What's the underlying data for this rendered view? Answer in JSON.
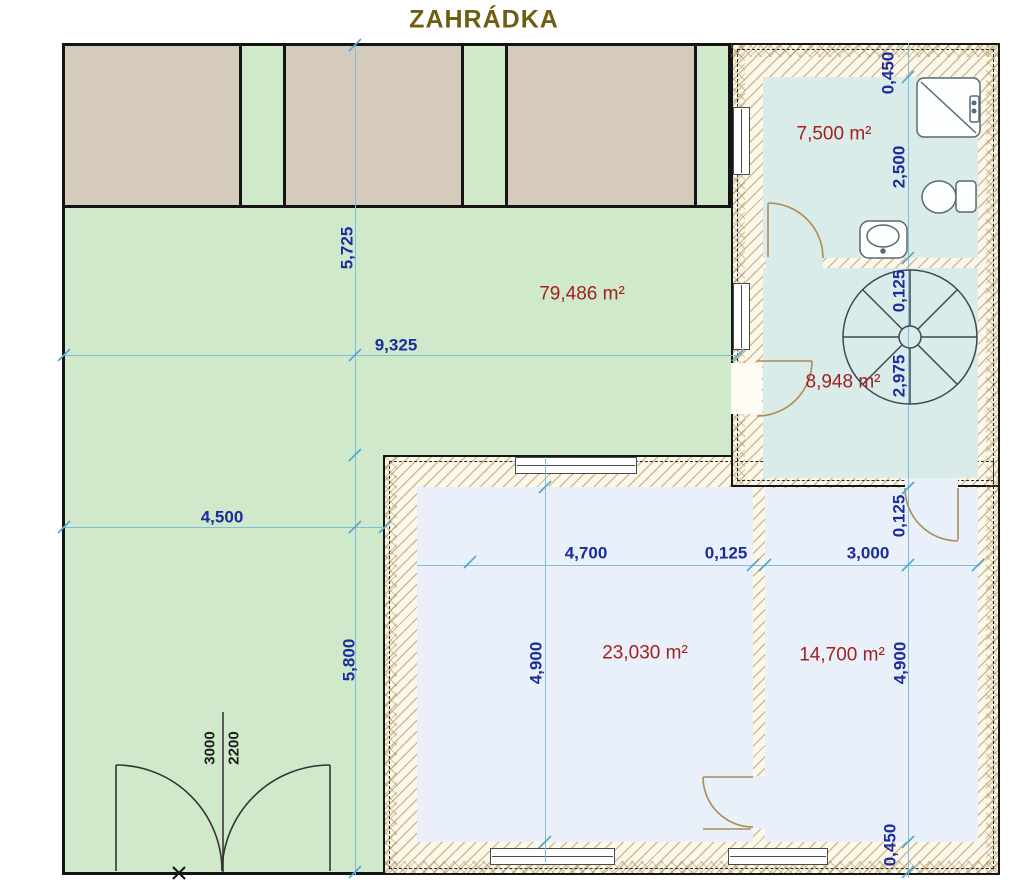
{
  "title": "ZAHRÁDKA",
  "rooms": {
    "garden": {
      "area": "79,486 m²"
    },
    "bathroom": {
      "area": "7,500 m²"
    },
    "staircase": {
      "area": "8,948 m²"
    },
    "room_large": {
      "area": "23,030 m²"
    },
    "room_small": {
      "area": "14,700 m²"
    }
  },
  "dimensions": {
    "garden_top_height": "5,725",
    "garden_width": "9,325",
    "garden_left_width": "4,500",
    "garden_bottom_height": "5,800",
    "room_large_width": "4,700",
    "partition_thickness": "0,125",
    "room_small_width": "3,000",
    "room_large_height": "4,900",
    "wall_top": "0,450",
    "bathroom_height": "2,500",
    "bathroom_wall_thickness": "0,125",
    "staircase_height": "2,975",
    "room_small_top_offset": "0,125",
    "room_small_height": "4,900",
    "wall_bottom": "0,450",
    "gate_width": "3000",
    "gate_height": "2200"
  },
  "colors": {
    "garden_green": "#cfe9ca",
    "terrace_tan": "#d5cbbd",
    "bath_floor_teal": "#d9ecea",
    "room_floor_blue": "#e9f0f9",
    "wall_hatch_cream": "#fbf7ea",
    "dimension_line_blue": "#7fbdd9",
    "dimension_text_navy": "#1b2c9d",
    "area_text_red": "#a32121",
    "title_olive": "#6f5e12"
  }
}
